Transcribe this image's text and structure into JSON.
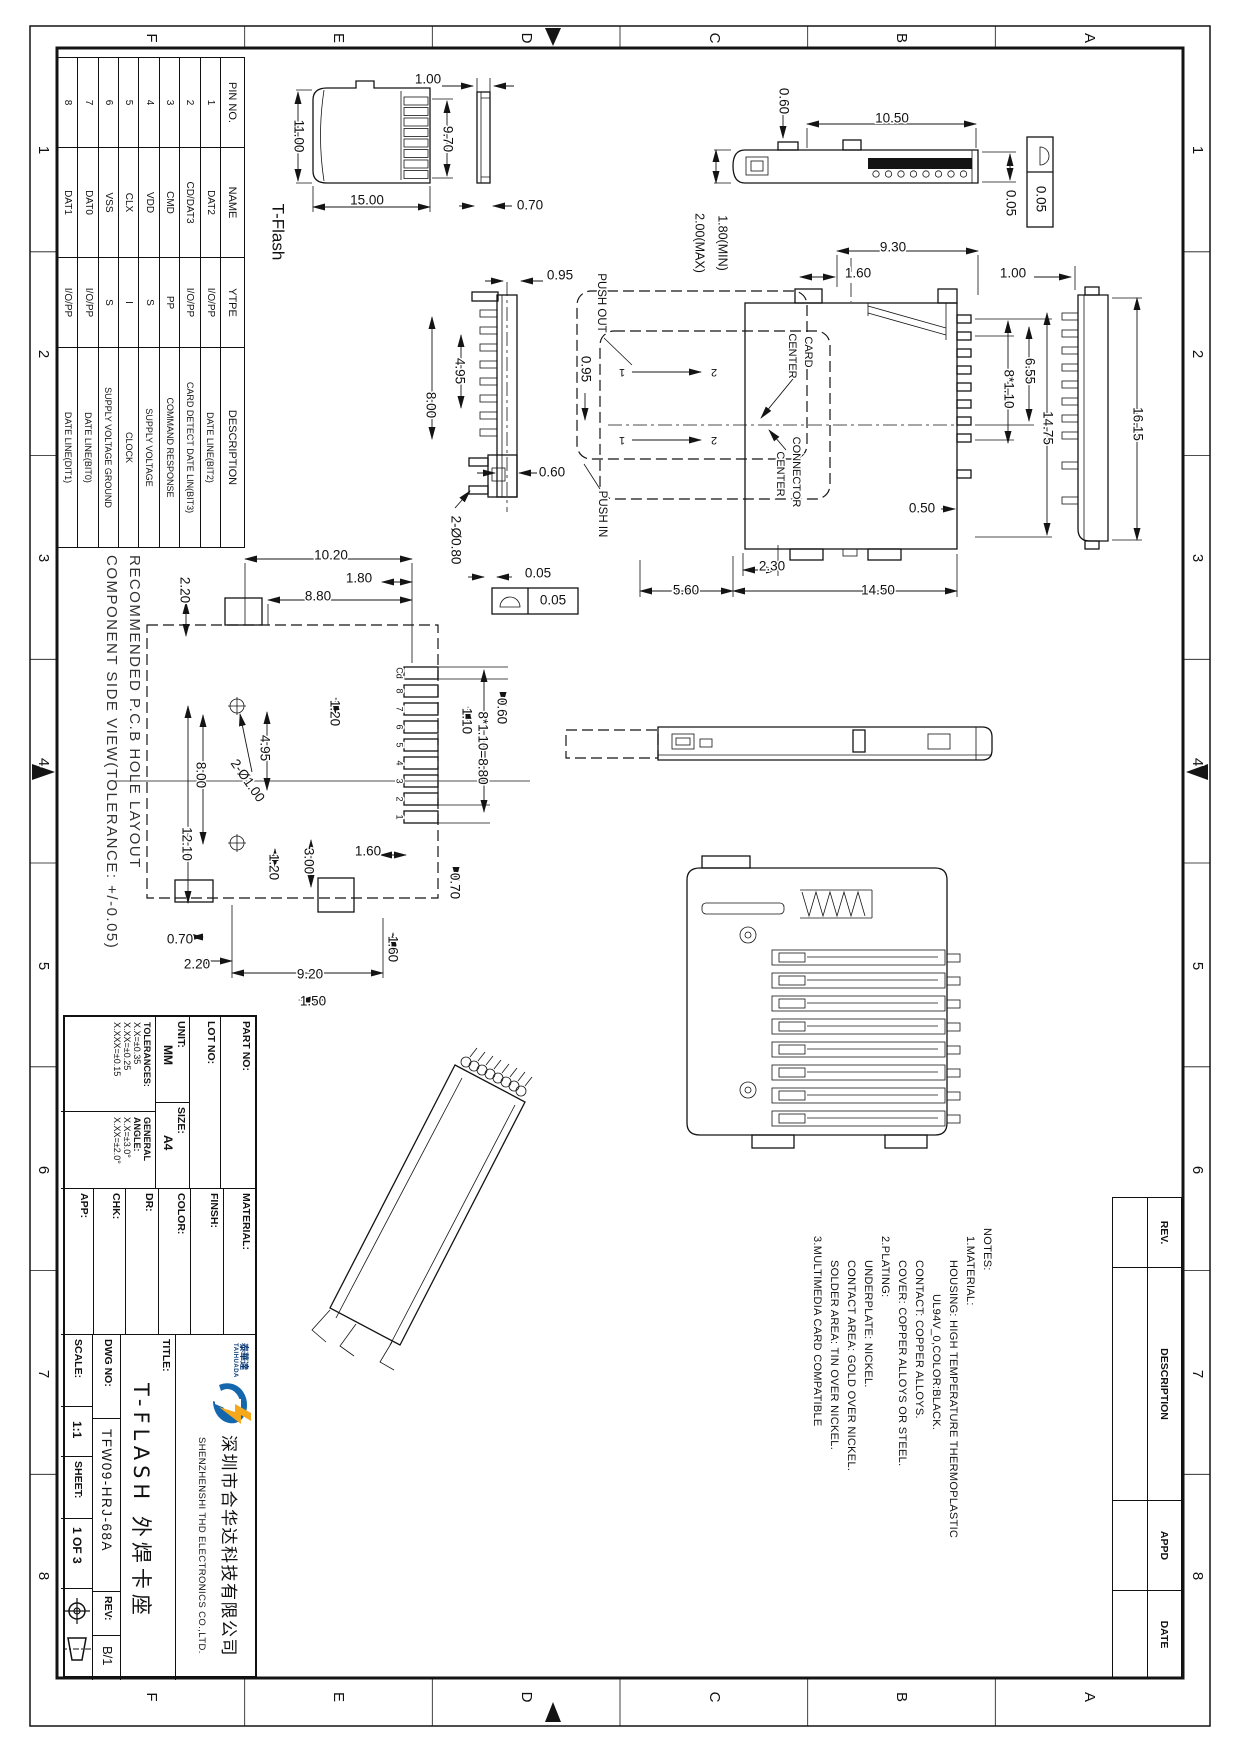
{
  "pin_table": {
    "headers": [
      "PIN NO.",
      "NAME",
      "YTPE",
      "DESCRIPTION"
    ],
    "rows": [
      [
        "1",
        "DAT2",
        "I/O/PP",
        "DATE LINE(BIT2)"
      ],
      [
        "2",
        "CD/DAT3",
        "I/O/PP",
        "CARD DETECT DATE LIN(BIT3)"
      ],
      [
        "3",
        "CMD",
        "PP",
        "COMMAND RESPONSE"
      ],
      [
        "4",
        "VDD",
        "S",
        "SUPPLY VOLTAGE"
      ],
      [
        "5",
        "CLX",
        "I",
        "CLOCK"
      ],
      [
        "6",
        "VSS",
        "S",
        "SUPPLY VOLTAGE GROUND"
      ],
      [
        "7",
        "DAT0",
        "I/O/PP",
        "DATE LINE(BIT0)"
      ],
      [
        "8",
        "DAT1",
        "I/O/PP",
        "DATE LINE(DIT1)"
      ]
    ]
  },
  "pcb_note": {
    "line1": "RECOMMENDED P.C.B HOLE LAYOUT",
    "line2": "COMPONENT SIDE VIEW(TOLERANCE: +/-0.05)"
  },
  "notes": {
    "lines": [
      "NOTES:",
      "1.MATERIAL:",
      "HOUSING: HIGH TEMPERATURE THERMOPLASTIC",
      "UL94V_0,COLOR:BLACK.",
      "CONTACT: COPPER ALLOYS.",
      "COVER: COPPER ALLOYS OR STEEL.",
      "2.PLATING:",
      "UNDERPLATE: NICKEL.",
      "CONTACT AREA: GOLD OVER NICKEL.",
      "SOLDER AREA: TIN OVER NICKEL.",
      "3.MULTIMEDIA CARD COMPATIBLE"
    ]
  },
  "title_block": {
    "part_no_label": "PART NO:",
    "lot_no_label": "LOT NO:",
    "unit_label": "UNIT:",
    "unit_value": "MM",
    "size_label": "SIZE:",
    "size_value": "A4",
    "tolerances_label": "TOLERANCES:",
    "tol1": "X.X=±0.35",
    "tol2": "X.XX=±0.25",
    "tol3": "X.XXX=±0.15",
    "angle_label1": "GENERAL",
    "angle_label2": "ANGLE:",
    "angle1": "X.X=±3.0°",
    "angle2": "X.XX=±2.0°",
    "material_label": "MATERIAL:",
    "finish_label": "FINSH:",
    "color_label": "COLOR:",
    "dr_label": "DR:",
    "chk_label": "CHK:",
    "app_label": "APP:",
    "title_label": "TITLE:",
    "logo_cn": "泰華達",
    "logo_text": "TAIHUADA",
    "company_cn": "深圳市合华达科技有限公司",
    "company_en": "SHENZHENSHI THD ELECTRONICS CO.,LTD.",
    "product_title": "T-FLASH 外焊卡座",
    "dwg_no_label": "DWG NO:",
    "dwg_no": "TFW09-HRJ-68A",
    "rev_label": "REV:",
    "rev": "B/1",
    "scale_label": "SCALE:",
    "scale": "1:1",
    "sheet_label": "SHEET:",
    "sheet": "1 OF 3"
  },
  "rev_table": {
    "headers": [
      "REV.",
      "DESCRIPTION",
      "APPD",
      "DATE"
    ]
  },
  "colors": {
    "line": "#141414",
    "logo_blue": "#1467ad",
    "logo_yellow": "#f5a81c"
  },
  "annotations": [
    {
      "t": "1.00",
      "x": 428,
      "y": 80,
      "r": 0
    },
    {
      "t": "9.70",
      "x": 447,
      "y": 139,
      "r": 90
    },
    {
      "t": "11.00",
      "x": 298,
      "y": 136,
      "r": 90
    },
    {
      "t": "15.00",
      "x": 367,
      "y": 201,
      "r": 0
    },
    {
      "t": "0.70",
      "x": 530,
      "y": 206,
      "r": 0
    },
    {
      "t": "T-Flash",
      "x": 277,
      "y": 232,
      "r": 90,
      "fs": 17
    },
    {
      "t": "0.60",
      "x": 783,
      "y": 101,
      "r": 90
    },
    {
      "t": "10.50",
      "x": 892,
      "y": 119,
      "r": 0
    },
    {
      "t": "0.05",
      "x": 1010,
      "y": 203,
      "r": 90
    },
    {
      "t": "0.05",
      "x": 1040,
      "y": 199,
      "r": 90
    },
    {
      "t": "1.80(MIN)",
      "x": 722,
      "y": 243,
      "r": 90,
      "fs": 12.5
    },
    {
      "t": "2.00(MAX)",
      "x": 699,
      "y": 243,
      "r": 90,
      "fs": 12.5
    },
    {
      "t": "9.30",
      "x": 893,
      "y": 248,
      "r": 0
    },
    {
      "t": "1.60",
      "x": 858,
      "y": 274,
      "r": 0
    },
    {
      "t": "1.00",
      "x": 1013,
      "y": 274,
      "r": 0
    },
    {
      "t": "PUSH OUT",
      "x": 601,
      "y": 303,
      "r": 90,
      "fs": 11.5
    },
    {
      "t": "0.95",
      "x": 585,
      "y": 369,
      "r": 90
    },
    {
      "t": "CARD",
      "x": 808,
      "y": 352,
      "r": 90,
      "fs": 11
    },
    {
      "t": "CENTER",
      "x": 792,
      "y": 356,
      "r": 90,
      "fs": 11
    },
    {
      "t": "CONNECTOR",
      "x": 796,
      "y": 472,
      "r": 90,
      "fs": 11
    },
    {
      "t": "CENTER",
      "x": 780,
      "y": 474,
      "r": 90,
      "fs": 11
    },
    {
      "t": "PUSH IN",
      "x": 602,
      "y": 514,
      "r": 90,
      "fs": 11.5
    },
    {
      "t": "1",
      "x": 622,
      "y": 372,
      "r": 180,
      "fs": 11
    },
    {
      "t": "2",
      "x": 714,
      "y": 372,
      "r": 180,
      "fs": 11
    },
    {
      "t": "1",
      "x": 622,
      "y": 440,
      "r": 180,
      "fs": 11
    },
    {
      "t": "2",
      "x": 714,
      "y": 440,
      "r": 180,
      "fs": 11
    },
    {
      "t": "2.30",
      "x": 772,
      "y": 567,
      "r": 0
    },
    {
      "t": "5.60",
      "x": 686,
      "y": 591,
      "r": 0
    },
    {
      "t": "14.50",
      "x": 878,
      "y": 591,
      "r": 0
    },
    {
      "t": "0.50",
      "x": 922,
      "y": 509,
      "r": 0
    },
    {
      "t": "6.55",
      "x": 1029,
      "y": 371,
      "r": 90
    },
    {
      "t": "8*1.10",
      "x": 1008,
      "y": 389,
      "r": 90
    },
    {
      "t": "14.75",
      "x": 1047,
      "y": 428,
      "r": 90
    },
    {
      "t": "16.15",
      "x": 1137,
      "y": 424,
      "r": 90
    },
    {
      "t": "0.95",
      "x": 560,
      "y": 276,
      "r": 0
    },
    {
      "t": "4.95",
      "x": 459,
      "y": 371,
      "r": 90
    },
    {
      "t": "8.00",
      "x": 430,
      "y": 405,
      "r": 90
    },
    {
      "t": "0.60",
      "x": 552,
      "y": 473,
      "r": 0
    },
    {
      "t": "2-Ø0.80",
      "x": 455,
      "y": 540,
      "r": 90
    },
    {
      "t": "0.05",
      "x": 538,
      "y": 574,
      "r": 0
    },
    {
      "t": "0.05",
      "x": 553,
      "y": 601,
      "r": 0
    },
    {
      "t": "10.20",
      "x": 331,
      "y": 556,
      "r": 0
    },
    {
      "t": "1.80",
      "x": 359,
      "y": 579,
      "r": 0
    },
    {
      "t": "8.80",
      "x": 318,
      "y": 597,
      "r": 0
    },
    {
      "t": "2.20",
      "x": 184,
      "y": 590,
      "r": 90
    },
    {
      "t": "1.20",
      "x": 334,
      "y": 713,
      "r": 90
    },
    {
      "t": "4.95",
      "x": 264,
      "y": 748,
      "r": 90
    },
    {
      "t": "2-Ø1.00",
      "x": 247,
      "y": 781,
      "r": 55
    },
    {
      "t": "8.00",
      "x": 200,
      "y": 775,
      "r": 90
    },
    {
      "t": "12.10",
      "x": 186,
      "y": 844,
      "r": 90
    },
    {
      "t": "3.00",
      "x": 308,
      "y": 861,
      "r": 90
    },
    {
      "t": "1.20",
      "x": 273,
      "y": 867,
      "r": 90
    },
    {
      "t": "1.60",
      "x": 368,
      "y": 852,
      "r": 0
    },
    {
      "t": "0.60",
      "x": 501,
      "y": 711,
      "r": 90
    },
    {
      "t": "1.10",
      "x": 466,
      "y": 721,
      "r": 90
    },
    {
      "t": "8*1.10=8.80",
      "x": 482,
      "y": 748,
      "r": 90
    },
    {
      "t": "0.70",
      "x": 454,
      "y": 886,
      "r": 90
    },
    {
      "t": "0.70",
      "x": 180,
      "y": 940,
      "r": 0
    },
    {
      "t": "2.20",
      "x": 197,
      "y": 965,
      "r": 0
    },
    {
      "t": "9.20",
      "x": 310,
      "y": 975,
      "r": 0
    },
    {
      "t": "1.60",
      "x": 392,
      "y": 949,
      "r": 90
    },
    {
      "t": "1.50",
      "x": 313,
      "y": 1002,
      "r": 0
    },
    {
      "t": "Cd",
      "x": 399,
      "y": 673,
      "r": 90,
      "fs": 9,
      "n": "pad-label"
    },
    {
      "t": "8",
      "x": 399,
      "y": 691,
      "r": 90,
      "fs": 9,
      "n": "pad-label"
    },
    {
      "t": "7",
      "x": 399,
      "y": 709,
      "r": 90,
      "fs": 9,
      "n": "pad-label"
    },
    {
      "t": "6",
      "x": 399,
      "y": 727,
      "r": 90,
      "fs": 9,
      "n": "pad-label"
    },
    {
      "t": "5",
      "x": 399,
      "y": 745,
      "r": 90,
      "fs": 9,
      "n": "pad-label"
    },
    {
      "t": "4",
      "x": 399,
      "y": 763,
      "r": 90,
      "fs": 9,
      "n": "pad-label"
    },
    {
      "t": "3",
      "x": 399,
      "y": 781,
      "r": 90,
      "fs": 9,
      "n": "pad-label"
    },
    {
      "t": "2",
      "x": 399,
      "y": 799,
      "r": 90,
      "fs": 9,
      "n": "pad-label"
    },
    {
      "t": "1",
      "x": 399,
      "y": 817,
      "r": 90,
      "fs": 9,
      "n": "pad-label"
    },
    {
      "t": "F",
      "x": 151,
      "y": 38,
      "r": 90,
      "fs": 15,
      "n": "grid-label"
    },
    {
      "t": "E",
      "x": 338,
      "y": 38,
      "r": 90,
      "fs": 15,
      "n": "grid-label"
    },
    {
      "t": "D",
      "x": 526,
      "y": 38,
      "r": 90,
      "fs": 15,
      "n": "grid-label"
    },
    {
      "t": "C",
      "x": 714,
      "y": 38,
      "r": 90,
      "fs": 15,
      "n": "grid-label"
    },
    {
      "t": "B",
      "x": 901,
      "y": 38,
      "r": 90,
      "fs": 15,
      "n": "grid-label"
    },
    {
      "t": "A",
      "x": 1089,
      "y": 38,
      "r": 90,
      "fs": 15,
      "n": "grid-label"
    },
    {
      "t": "F",
      "x": 151,
      "y": 1697,
      "r": 90,
      "fs": 15,
      "n": "grid-label"
    },
    {
      "t": "E",
      "x": 338,
      "y": 1697,
      "r": 90,
      "fs": 15,
      "n": "grid-label"
    },
    {
      "t": "D",
      "x": 526,
      "y": 1697,
      "r": 90,
      "fs": 15,
      "n": "grid-label"
    },
    {
      "t": "C",
      "x": 714,
      "y": 1697,
      "r": 90,
      "fs": 15,
      "n": "grid-label"
    },
    {
      "t": "B",
      "x": 901,
      "y": 1697,
      "r": 90,
      "fs": 15,
      "n": "grid-label"
    },
    {
      "t": "A",
      "x": 1089,
      "y": 1697,
      "r": 90,
      "fs": 15,
      "n": "grid-label"
    },
    {
      "t": "1",
      "x": 43,
      "y": 150,
      "r": 90,
      "fs": 15,
      "n": "grid-label"
    },
    {
      "t": "2",
      "x": 43,
      "y": 354,
      "r": 90,
      "fs": 15,
      "n": "grid-label"
    },
    {
      "t": "3",
      "x": 43,
      "y": 558,
      "r": 90,
      "fs": 15,
      "n": "grid-label"
    },
    {
      "t": "4",
      "x": 43,
      "y": 762,
      "r": 90,
      "fs": 15,
      "n": "grid-label"
    },
    {
      "t": "5",
      "x": 43,
      "y": 966,
      "r": 90,
      "fs": 15,
      "n": "grid-label"
    },
    {
      "t": "6",
      "x": 43,
      "y": 1170,
      "r": 90,
      "fs": 15,
      "n": "grid-label"
    },
    {
      "t": "7",
      "x": 43,
      "y": 1374,
      "r": 90,
      "fs": 15,
      "n": "grid-label"
    },
    {
      "t": "8",
      "x": 43,
      "y": 1576,
      "r": 90,
      "fs": 15,
      "n": "grid-label"
    },
    {
      "t": "1",
      "x": 1197,
      "y": 150,
      "r": 90,
      "fs": 15,
      "n": "grid-label"
    },
    {
      "t": "2",
      "x": 1197,
      "y": 354,
      "r": 90,
      "fs": 15,
      "n": "grid-label"
    },
    {
      "t": "3",
      "x": 1197,
      "y": 558,
      "r": 90,
      "fs": 15,
      "n": "grid-label"
    },
    {
      "t": "4",
      "x": 1197,
      "y": 762,
      "r": 90,
      "fs": 15,
      "n": "grid-label"
    },
    {
      "t": "5",
      "x": 1197,
      "y": 966,
      "r": 90,
      "fs": 15,
      "n": "grid-label"
    },
    {
      "t": "6",
      "x": 1197,
      "y": 1170,
      "r": 90,
      "fs": 15,
      "n": "grid-label"
    },
    {
      "t": "7",
      "x": 1197,
      "y": 1374,
      "r": 90,
      "fs": 15,
      "n": "grid-label"
    },
    {
      "t": "8",
      "x": 1197,
      "y": 1576,
      "r": 90,
      "fs": 15,
      "n": "grid-label"
    }
  ]
}
